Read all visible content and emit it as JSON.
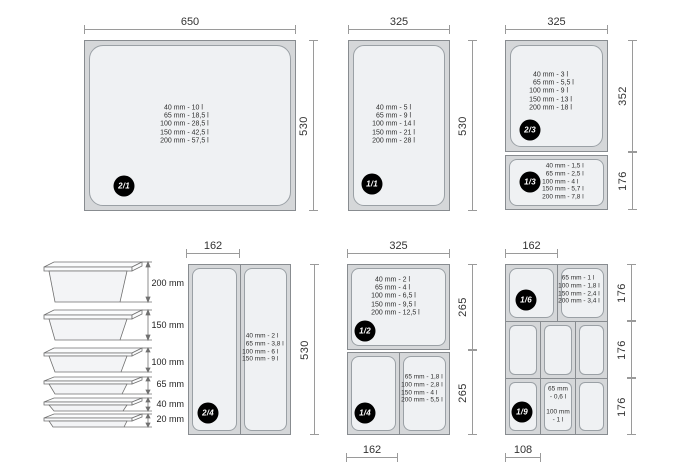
{
  "diagram": {
    "title_semantic": "gastronorm-container-sizes",
    "pans": {
      "gn21": {
        "badge": "2/1",
        "capacities": [
          "40 mm - 10 l",
          "65 mm - 18,5 l",
          "100 mm - 28,5 l",
          "150 mm - 42,5 l",
          "200 mm - 57,5 l"
        ]
      },
      "gn11": {
        "badge": "1/1",
        "capacities": [
          "40 mm - 5 l",
          "65 mm - 9 l",
          "100 mm - 14 l",
          "150 mm - 21 l",
          "200 mm - 28 l"
        ]
      },
      "gn23": {
        "badge": "2/3",
        "capacities": [
          "40 mm - 3 l",
          "65 mm - 5,5 l",
          "100 mm - 9 l",
          "150 mm - 13 l",
          "200 mm - 18 l"
        ]
      },
      "gn13": {
        "badge": "1/3",
        "capacities": [
          "40 mm - 1,5 l",
          "65 mm - 2,5 l",
          "100 mm - 4 l",
          "150 mm - 5,7 l",
          "200 mm - 7,8 l"
        ]
      },
      "gn24": {
        "badge": "2/4",
        "capacities": [
          "40 mm - 2 l",
          "65 mm - 3,8 l",
          "100 mm - 6 l",
          "150 mm - 9 l"
        ]
      },
      "gn12": {
        "badge": "1/2",
        "capacities": [
          "40 mm - 2 l",
          "65 mm - 4 l",
          "100 mm - 6,5 l",
          "150 mm - 9,5 l",
          "200 mm - 12,5 l"
        ]
      },
      "gn14": {
        "badge": "1/4",
        "capacities": [
          "65 mm - 1,8 l",
          "100 mm - 2,8 l",
          "150 mm - 4 l",
          "200 mm - 5,5 l"
        ]
      },
      "gn16": {
        "badge": "1/6",
        "capacities": [
          "65 mm - 1 l",
          "100 mm - 1,8 l",
          "150 mm - 2,4 l",
          "200 mm - 3,4 l"
        ]
      },
      "gn19": {
        "badge": "1/9",
        "capacities": [
          "65 mm",
          "- 0,6 l",
          "",
          "100 mm",
          "- 1 l"
        ]
      }
    },
    "dimensions": {
      "gn21": {
        "top": "650",
        "right": "530"
      },
      "gn11": {
        "top": "325",
        "right": "530"
      },
      "gn23_13": {
        "top": "325",
        "upper": "352",
        "lower": "176"
      },
      "gn24": {
        "top": "162",
        "right": "530"
      },
      "gn12_14": {
        "top": "325",
        "upper": "265",
        "lower": "265",
        "bottom": "162"
      },
      "gn16_19": {
        "top": "162",
        "row1": "176",
        "row2": "176",
        "row3": "176",
        "bottom": "108"
      }
    },
    "depth_stack": {
      "labels": [
        "200 mm",
        "150 mm",
        "100 mm",
        "65 mm",
        "40 mm",
        "20 mm"
      ]
    },
    "colors": {
      "frame": "#d5d7d9",
      "pan_fill": "#eff1f3",
      "frame_border": "#888c90",
      "pan_border": "#9aa0a5",
      "dim_line": "#9a9a9a",
      "text": "#333333",
      "badge_bg": "#000000",
      "badge_text": "#ffffff"
    }
  }
}
